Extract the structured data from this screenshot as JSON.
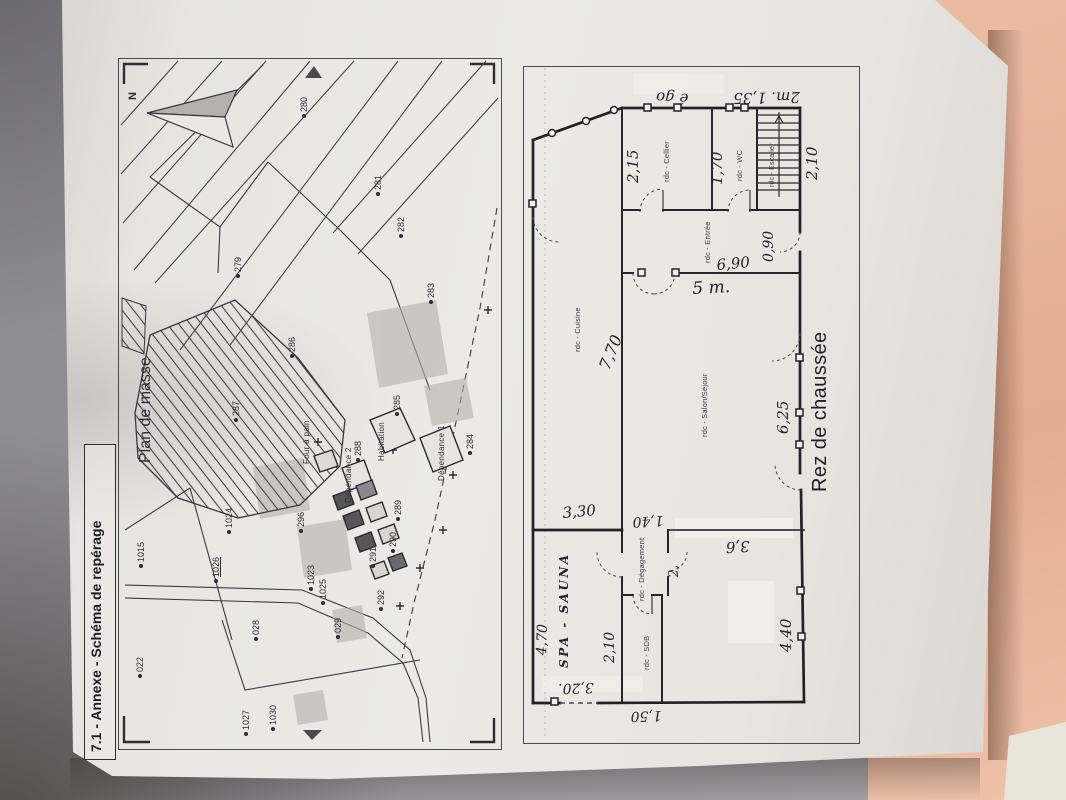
{
  "colors": {
    "surface": "#ecbda3",
    "paper": "#ebeae6",
    "ink": "#2d2d33"
  },
  "title": "7.1 - Annexe - Schéma de repérage",
  "site_plan": {
    "label": "Plan de masse",
    "north": "N",
    "parcel_numbers": [
      {
        "n": "280",
        "x": 300,
        "y": 118
      },
      {
        "n": "281",
        "x": 374,
        "y": 196
      },
      {
        "n": "282",
        "x": 397,
        "y": 238
      },
      {
        "n": "279",
        "x": 234,
        "y": 278
      },
      {
        "n": "283",
        "x": 427,
        "y": 304
      },
      {
        "n": "286",
        "x": 288,
        "y": 358
      },
      {
        "n": "287",
        "x": 232,
        "y": 422
      },
      {
        "n": "285",
        "x": 393,
        "y": 416
      },
      {
        "n": "288",
        "x": 354,
        "y": 462
      },
      {
        "n": "284",
        "x": 466,
        "y": 455
      },
      {
        "n": "296",
        "x": 297,
        "y": 533
      },
      {
        "n": "289",
        "x": 394,
        "y": 521
      },
      {
        "n": "290",
        "x": 389,
        "y": 553
      },
      {
        "n": "291",
        "x": 369,
        "y": 568
      },
      {
        "n": "1023",
        "x": 307,
        "y": 591
      },
      {
        "n": "1025",
        "x": 319,
        "y": 605
      },
      {
        "n": "292",
        "x": 377,
        "y": 611
      },
      {
        "n": "1024",
        "x": 225,
        "y": 534
      },
      {
        "n": "1015",
        "x": 137,
        "y": 568
      },
      {
        "n": "1026",
        "x": 212,
        "y": 583,
        "cls": "u"
      },
      {
        "n": "022",
        "x": 136,
        "y": 678
      },
      {
        "n": "028",
        "x": 252,
        "y": 641
      },
      {
        "n": "029",
        "x": 334,
        "y": 639
      },
      {
        "n": "1030",
        "x": 269,
        "y": 731
      },
      {
        "n": "1027",
        "x": 242,
        "y": 736
      }
    ],
    "building_labels": [
      {
        "name": "Four à pain",
        "x": 303,
        "y": 464
      },
      {
        "name": "Dépendance 2",
        "x": 345,
        "y": 503
      },
      {
        "name": "Habitation",
        "x": 378,
        "y": 461
      },
      {
        "name": "Dépendance 1",
        "x": 438,
        "y": 481
      }
    ]
  },
  "floor_plan": {
    "caption": "Rez de chaussée",
    "room_labels": [
      {
        "t": "rdc - Cellier",
        "x": 663,
        "y": 182
      },
      {
        "t": "rdc - WC",
        "x": 736,
        "y": 181
      },
      {
        "t": "rdc - Escalier",
        "x": 769,
        "y": 187,
        "fs": 7
      },
      {
        "t": "rdc - Entrée",
        "x": 704,
        "y": 263
      },
      {
        "t": "rdc - Cuisine",
        "x": 574,
        "y": 352
      },
      {
        "t": "rdc - Salon/Séjour",
        "x": 701,
        "y": 437
      },
      {
        "t": "rdc - Dégagement",
        "x": 638,
        "y": 601
      },
      {
        "t": "rdc - SDB",
        "x": 643,
        "y": 670
      }
    ],
    "dimension_annotations": [
      {
        "t": "2,15",
        "x": 626,
        "y": 183,
        "rot": -90
      },
      {
        "t": "1,70",
        "x": 710,
        "y": 185,
        "rot": -90
      },
      {
        "t": "2,10",
        "x": 805,
        "y": 180,
        "rot": -90
      },
      {
        "t": "0,90",
        "x": 762,
        "y": 262,
        "rot": -90,
        "fs": 14
      },
      {
        "t": "6,90",
        "x": 716,
        "y": 258,
        "rot": -5
      },
      {
        "t": "5 m.",
        "x": 692,
        "y": 281,
        "rot": -3,
        "fs": 17
      },
      {
        "t": "7,70",
        "x": 597,
        "y": 366,
        "rot": -68,
        "fs": 16
      },
      {
        "t": "6,25",
        "x": 776,
        "y": 434,
        "rot": -90
      },
      {
        "t": "3,30",
        "x": 562,
        "y": 506,
        "rot": -5
      },
      {
        "t": "1,40",
        "x": 664,
        "y": 527,
        "rot": 177,
        "fs": 14
      },
      {
        "t": "2,",
        "x": 668,
        "y": 578,
        "rot": -95,
        "fs": 13
      },
      {
        "t": "3,6",
        "x": 750,
        "y": 553,
        "rot": 177
      },
      {
        "t": "SPA - SAUNA",
        "x": 558,
        "y": 668,
        "rot": -90,
        "fs": 12,
        "cls": "caps"
      },
      {
        "t": "4,70",
        "x": 535,
        "y": 655,
        "rot": -88,
        "fs": 14
      },
      {
        "t": "2,10",
        "x": 603,
        "y": 663,
        "rot": -90,
        "fs": 14
      },
      {
        "t": "3,20.",
        "x": 594,
        "y": 694,
        "rot": 178,
        "fs": 14
      },
      {
        "t": "1,50",
        "x": 662,
        "y": 722,
        "rot": 178,
        "fs": 14
      },
      {
        "t": "4,40",
        "x": 779,
        "y": 652,
        "rot": -90
      },
      {
        "t": "2m. 1,35",
        "x": 800,
        "y": 104,
        "rot": 179
      },
      {
        "t": "é go",
        "x": 688,
        "y": 106,
        "rot": 183
      }
    ]
  }
}
